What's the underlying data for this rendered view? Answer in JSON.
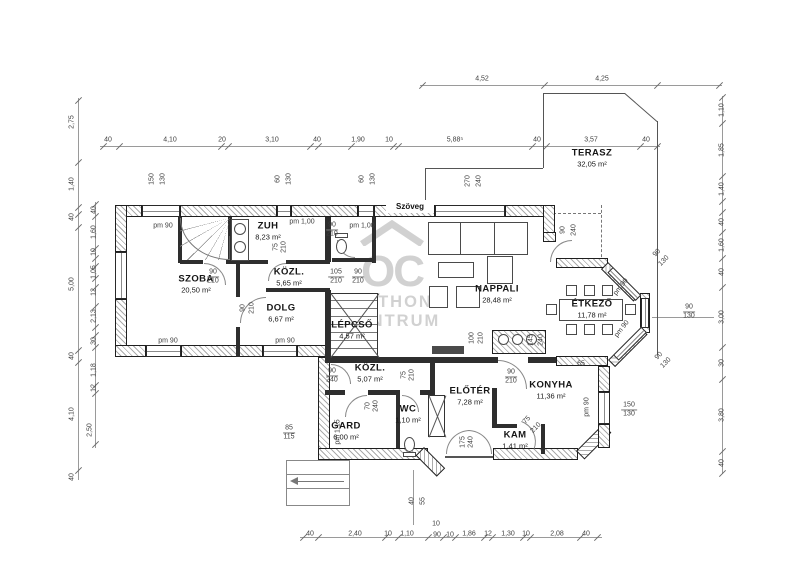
{
  "tag": "Szöveg",
  "watermark": {
    "monogram": "OC",
    "line1": "OTTHON",
    "line2": "CENTRUM"
  },
  "colors": {
    "wall_line": "#1f1f1f",
    "hatch": "#ababab",
    "dim_text": "#3f3f3f",
    "watermark": "#c9c9c9"
  },
  "rooms": [
    {
      "name": "SZOBA",
      "area": "20,50 m²",
      "x": 196,
      "y": 284
    },
    {
      "name": "ZUH",
      "area": "8,23 m²",
      "x": 268,
      "y": 231
    },
    {
      "name": "KÖZL.",
      "area": "5,65 m²",
      "x": 289,
      "y": 277
    },
    {
      "name": "DOLG",
      "area": "6,67 m²",
      "x": 281,
      "y": 313
    },
    {
      "name": "LÉPCSŐ",
      "area": "4,57 m²",
      "x": 352,
      "y": 330
    },
    {
      "name": "NAPPALI",
      "area": "28,48 m²",
      "x": 497,
      "y": 294
    },
    {
      "name": "ÉTKEZŐ",
      "area": "11,78 m²",
      "x": 592,
      "y": 309
    },
    {
      "name": "TERASZ",
      "area": "32,05 m²",
      "x": 592,
      "y": 158
    },
    {
      "name": "KÖZL.",
      "area": "5,07 m²",
      "x": 370,
      "y": 373
    },
    {
      "name": "GARD",
      "area": "6,00 m²",
      "x": 346,
      "y": 431
    },
    {
      "name": "WC",
      "area": "1,10 m²",
      "x": 408,
      "y": 414
    },
    {
      "name": "ELŐTÉR",
      "area": "7,28 m²",
      "x": 470,
      "y": 396
    },
    {
      "name": "KAM",
      "area": "1,41 m²",
      "x": 515,
      "y": 440
    },
    {
      "name": "KONYHA",
      "area": "11,36 m²",
      "x": 551,
      "y": 390
    }
  ],
  "dims": [
    {
      "t": "4,52",
      "x": 482,
      "y": 79
    },
    {
      "t": "4,25",
      "x": 602,
      "y": 79
    },
    {
      "t": "40",
      "x": 108,
      "y": 140
    },
    {
      "t": "4,10",
      "x": 170,
      "y": 140
    },
    {
      "t": "20",
      "x": 222,
      "y": 140
    },
    {
      "t": "3,10",
      "x": 272,
      "y": 140
    },
    {
      "t": "40",
      "x": 317,
      "y": 140
    },
    {
      "t": "1,90",
      "x": 358,
      "y": 140
    },
    {
      "t": "10",
      "x": 389,
      "y": 140
    },
    {
      "t": "5,88⁵",
      "x": 455,
      "y": 140
    },
    {
      "t": "40",
      "x": 537,
      "y": 140
    },
    {
      "t": "3,57",
      "x": 591,
      "y": 140
    },
    {
      "t": "40",
      "x": 646,
      "y": 140
    },
    {
      "t": "150",
      "x": 152,
      "y": 179,
      "r": -90
    },
    {
      "t": "130",
      "x": 163,
      "y": 179,
      "r": -90
    },
    {
      "t": "60",
      "x": 278,
      "y": 179,
      "r": -90
    },
    {
      "t": "130",
      "x": 289,
      "y": 179,
      "r": -90
    },
    {
      "t": "60",
      "x": 362,
      "y": 179,
      "r": -90
    },
    {
      "t": "130",
      "x": 373,
      "y": 179,
      "r": -90
    },
    {
      "t": "270",
      "x": 468,
      "y": 181,
      "r": -90
    },
    {
      "t": "240",
      "x": 479,
      "y": 181,
      "r": -90
    },
    {
      "t": "2,75",
      "x": 72,
      "y": 122,
      "r": -90
    },
    {
      "t": "1,40",
      "x": 72,
      "y": 184,
      "r": -90
    },
    {
      "t": "40",
      "x": 72,
      "y": 217,
      "r": -90
    },
    {
      "t": "5,00",
      "x": 72,
      "y": 284,
      "r": -90
    },
    {
      "t": "40",
      "x": 72,
      "y": 356,
      "r": -90
    },
    {
      "t": "4,10",
      "x": 72,
      "y": 414,
      "r": -90
    },
    {
      "t": "40",
      "x": 72,
      "y": 477,
      "r": -90
    },
    {
      "t": "40",
      "x": 94,
      "y": 210,
      "r": -90
    },
    {
      "t": "1,60",
      "x": 94,
      "y": 232,
      "r": -90
    },
    {
      "t": "10",
      "x": 94,
      "y": 252,
      "r": -90
    },
    {
      "t": "1,05",
      "x": 94,
      "y": 272,
      "r": -90
    },
    {
      "t": "12",
      "x": 94,
      "y": 292,
      "r": -90
    },
    {
      "t": "2,13",
      "x": 94,
      "y": 316,
      "r": -90
    },
    {
      "t": "30",
      "x": 94,
      "y": 341,
      "r": -90
    },
    {
      "t": "1,18",
      "x": 94,
      "y": 370,
      "r": -90
    },
    {
      "t": "12",
      "x": 94,
      "y": 388,
      "r": -90
    },
    {
      "t": "2,50",
      "x": 90,
      "y": 430,
      "r": -90
    },
    {
      "t": "1,10",
      "x": 722,
      "y": 110,
      "r": -90
    },
    {
      "t": "1,85",
      "x": 722,
      "y": 150,
      "r": -90
    },
    {
      "t": "1,40",
      "x": 722,
      "y": 189,
      "r": -90
    },
    {
      "t": "40",
      "x": 722,
      "y": 222,
      "r": -90
    },
    {
      "t": "1,60",
      "x": 722,
      "y": 245,
      "r": -90
    },
    {
      "t": "40",
      "x": 722,
      "y": 272,
      "r": -90
    },
    {
      "t": "3,00",
      "x": 722,
      "y": 317,
      "r": -90
    },
    {
      "t": "30",
      "x": 722,
      "y": 363,
      "r": -90
    },
    {
      "t": "3,80",
      "x": 722,
      "y": 415,
      "r": -90
    },
    {
      "t": "40",
      "x": 722,
      "y": 463,
      "r": -90
    },
    {
      "t": "40",
      "x": 310,
      "y": 534
    },
    {
      "t": "2,40",
      "x": 355,
      "y": 534
    },
    {
      "t": "10",
      "x": 388,
      "y": 534
    },
    {
      "t": "1,10",
      "x": 407,
      "y": 534
    },
    {
      "t": "10",
      "x": 436,
      "y": 524
    },
    {
      "t": "90",
      "x": 437,
      "y": 535
    },
    {
      "t": "10",
      "x": 450,
      "y": 535
    },
    {
      "t": "1,86",
      "x": 469,
      "y": 534
    },
    {
      "t": "12",
      "x": 488,
      "y": 534
    },
    {
      "t": "1,30",
      "x": 508,
      "y": 534
    },
    {
      "t": "10",
      "x": 526,
      "y": 534
    },
    {
      "t": "2,08",
      "x": 557,
      "y": 534
    },
    {
      "t": "40",
      "x": 586,
      "y": 534
    },
    {
      "t": "40",
      "x": 412,
      "y": 501,
      "r": -90
    },
    {
      "t": "55",
      "x": 423,
      "y": 501,
      "r": -90
    },
    {
      "t": "pm 90",
      "x": 163,
      "y": 226
    },
    {
      "t": "pm 90",
      "x": 168,
      "y": 341
    },
    {
      "t": "pm 90",
      "x": 285,
      "y": 341
    },
    {
      "t": "pm 1,00",
      "x": 302,
      "y": 222
    },
    {
      "t": "pm 1,00",
      "x": 362,
      "y": 226
    },
    {
      "t": "pm 1,15",
      "x": 338,
      "y": 432,
      "r": -90
    },
    {
      "t": "pm 90",
      "x": 587,
      "y": 407,
      "r": -90
    },
    {
      "t": "pm 90",
      "x": 621,
      "y": 287,
      "r": -52
    },
    {
      "t": "pm 90",
      "x": 622,
      "y": 329,
      "r": -52
    },
    {
      "t": "65",
      "x": 581,
      "y": 364
    },
    {
      "t": "90",
      "b": "210",
      "x": 213,
      "y": 277
    },
    {
      "t": "105",
      "b": "210",
      "x": 336,
      "y": 277
    },
    {
      "t": "90",
      "b": "210",
      "x": 358,
      "y": 277
    },
    {
      "t": "90",
      "b": "210",
      "x": 332,
      "y": 230
    },
    {
      "t": "85",
      "b": "115",
      "x": 289,
      "y": 433
    },
    {
      "t": "90",
      "b": "240",
      "x": 332,
      "y": 376
    },
    {
      "t": "90",
      "b": "210",
      "x": 511,
      "y": 377
    },
    {
      "t": "150",
      "b": "130",
      "x": 629,
      "y": 410
    },
    {
      "t": "90",
      "b": "130",
      "x": 689,
      "y": 312
    },
    {
      "t": "90",
      "x": 243,
      "y": 308,
      "r": -90
    },
    {
      "t": "210",
      "x": 252,
      "y": 308,
      "r": -90
    },
    {
      "t": "75",
      "x": 276,
      "y": 247,
      "r": -90
    },
    {
      "t": "210",
      "x": 284,
      "y": 247,
      "r": -90
    },
    {
      "t": "100",
      "x": 472,
      "y": 338,
      "r": -90
    },
    {
      "t": "210",
      "x": 481,
      "y": 338,
      "r": -90
    },
    {
      "t": "145",
      "x": 531,
      "y": 340,
      "r": -90
    },
    {
      "t": "240",
      "x": 541,
      "y": 340,
      "r": -90
    },
    {
      "t": "90",
      "x": 563,
      "y": 230,
      "r": -90
    },
    {
      "t": "240",
      "x": 574,
      "y": 230,
      "r": -90
    },
    {
      "t": "70",
      "x": 368,
      "y": 406,
      "r": -90
    },
    {
      "t": "240",
      "x": 376,
      "y": 406,
      "r": -90
    },
    {
      "t": "75",
      "x": 404,
      "y": 375,
      "r": -90
    },
    {
      "t": "210",
      "x": 412,
      "y": 375,
      "r": -90
    },
    {
      "t": "175",
      "x": 463,
      "y": 442,
      "r": -90
    },
    {
      "t": "240",
      "x": 471,
      "y": 442,
      "r": -90
    },
    {
      "t": "75",
      "x": 527,
      "y": 420,
      "r": -45
    },
    {
      "t": "210",
      "x": 536,
      "y": 428,
      "r": -45
    },
    {
      "t": "90",
      "x": 657,
      "y": 253,
      "r": -45
    },
    {
      "t": "130",
      "x": 664,
      "y": 261,
      "r": -45
    },
    {
      "t": "90",
      "x": 659,
      "y": 356,
      "r": -45
    },
    {
      "t": "130",
      "x": 666,
      "y": 363,
      "r": -45
    }
  ]
}
